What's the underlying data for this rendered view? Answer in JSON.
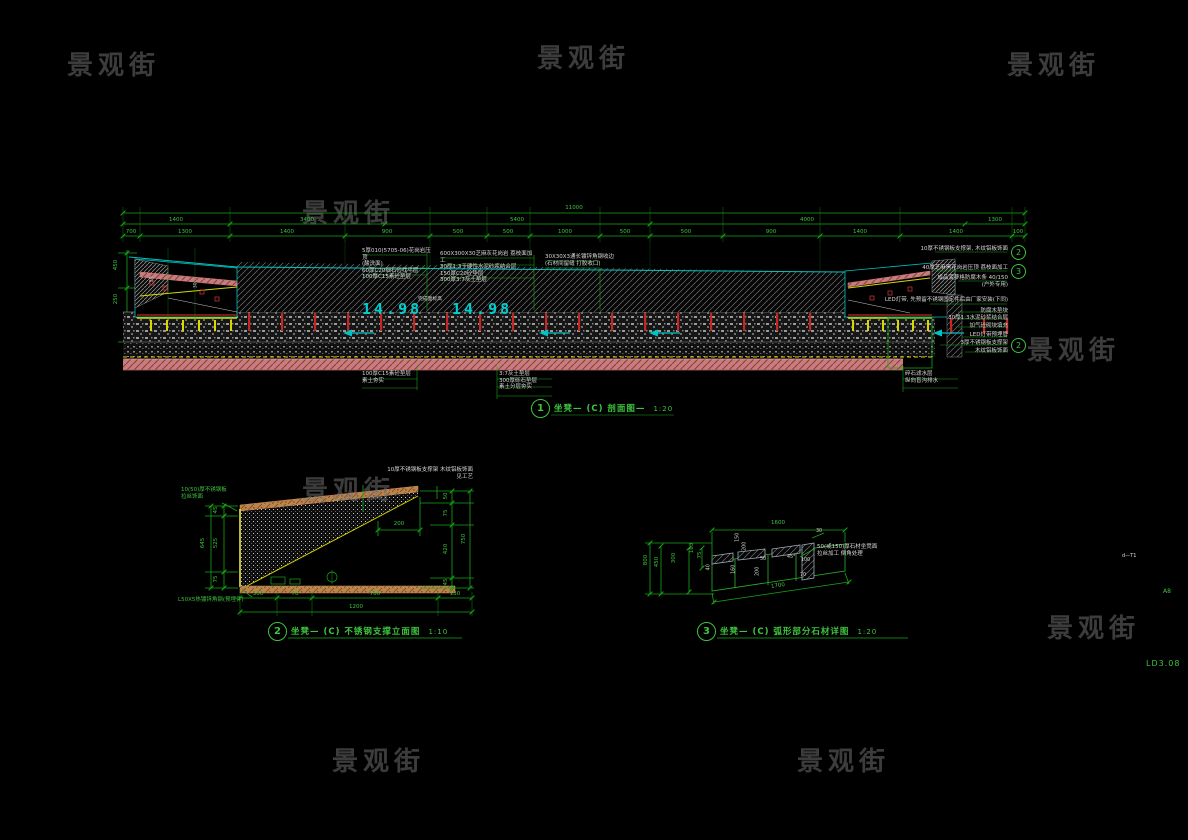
{
  "sheet": {
    "watermark_text": "景观街",
    "sheet_no": "LD3.08",
    "sheet_marker": "A8",
    "edge_note": "d—T1"
  },
  "colors": {
    "background": "#000000",
    "cad_green": "#17a817",
    "cad_cyan": "#00c2c2",
    "annotation_white": "#d8d8d8",
    "rebar_red": "#c22625",
    "steel_yellow": "#d8d800",
    "earth_pink": "#c67d7d",
    "wood_tan": "#b8854a"
  },
  "d1": {
    "bubble": "1",
    "title": "坐凳— (C)  剖面图—",
    "scale": "1:20",
    "dims": {
      "overall": "11000",
      "row1": [
        "1400",
        "3400",
        "5400",
        "4000",
        "1300"
      ],
      "row2": [
        "700",
        "1300",
        "1400",
        "900",
        "500",
        "500",
        "1000",
        "500",
        "500",
        "900",
        "1400",
        "1400",
        "100"
      ],
      "left": [
        "450",
        "250"
      ]
    },
    "levels": {
      "a": "14.98",
      "b": "14.98",
      "note": "完成面标高"
    },
    "notes_above": [
      "5厚010(5705-06)花岗岩压顶\n(酸洗面)\n60厚C20细石砼找平层\n100厚C15素砼垫层",
      "600X300X30芝麻灰花岗岩 荔枝面加工\n30厚1:3干硬性水泥砂浆结合层\n150厚C20砼垫层\n300厚3:7灰土垫层",
      "30X30X3通长镀锌角钢收边\n(石材间留缝 打胶收口)"
    ],
    "notes_right": [
      "10厚不锈钢板支撑架, 木纹铝板饰面",
      "40厚芝麻黑花岗岩压顶 荔枝面加工",
      "成品菠萝格防腐木条 40/150\n(户外专用)",
      "LED灯带, 先预留不锈钢固定件后由厂家安装(下同)",
      "防腐木垫块",
      "30厚1:3水泥砂浆结合层",
      "加气砼砌块填充",
      "LED灯带预埋管",
      "3厚不锈钢板支撑架",
      "木纹铝板饰面"
    ],
    "ref_bubbles": [
      "2",
      "3",
      "2"
    ],
    "notes_below": [
      "100厚C15素砼垫层\n素土夯实",
      "3:7灰土垫层\n300厚砾石垫层\n素土分层夯实",
      "碎石滤水层\n纵向盲沟排水"
    ],
    "bench_labels": [
      "50",
      "30"
    ]
  },
  "d2": {
    "bubble": "2",
    "title": "坐凳— (C)  不锈钢支撑立面图",
    "scale": "1:10",
    "labels": {
      "top": "10厚不锈钢板支撑架 木纹铝板饰面\n见工艺",
      "top_left": "10(50)厚不锈钢板\n拉丝饰面",
      "bottom_left": "L50X5热镀锌角钢(预埋件)"
    },
    "dims": {
      "bottom": [
        "300",
        "70",
        "700",
        "130"
      ],
      "bottom_overall": "1200",
      "left": [
        "45",
        "525",
        "75"
      ],
      "left_overall": "645",
      "right": [
        "50",
        "75",
        "420",
        "45"
      ],
      "right_overall": "750",
      "inner": "200"
    }
  },
  "d3": {
    "bubble": "3",
    "title": "坐凳— (C)  弧形部分石材详图",
    "scale": "1:20",
    "label_right": "50(或150)厚石材坐凳面\n拉丝加工 倒角处理",
    "dims": {
      "top": "1600",
      "bottom": "1700",
      "left": [
        "800",
        "450",
        "300",
        "163",
        "75"
      ],
      "inner": [
        "150",
        "200",
        "50",
        "45°",
        "100",
        "160",
        "200",
        "70",
        "40"
      ],
      "right_small": "30"
    }
  }
}
